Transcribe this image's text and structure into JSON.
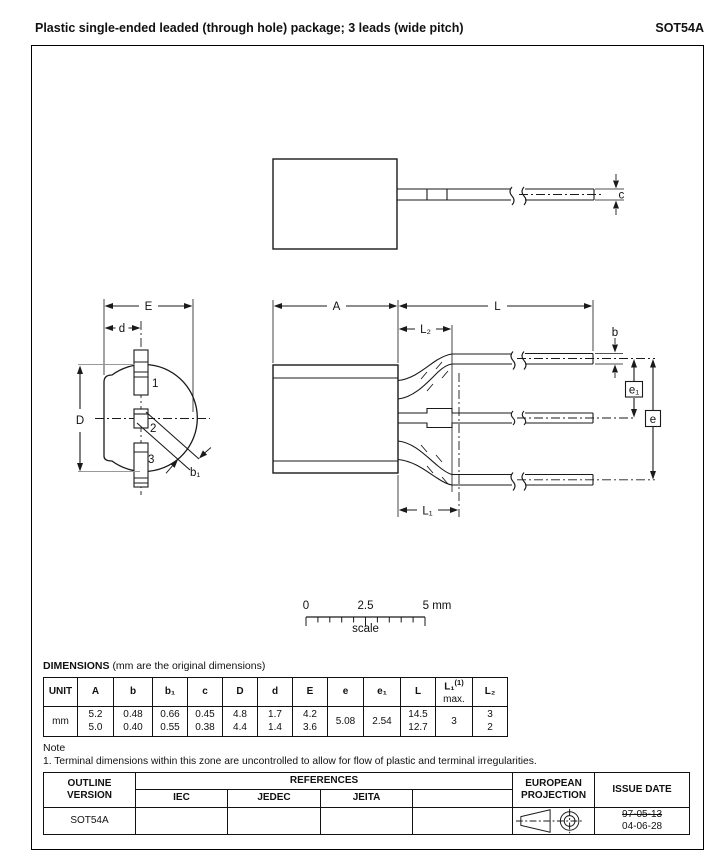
{
  "header": {
    "title": "Plastic single-ended leaded (through hole) package; 3 leads (wide pitch)",
    "package_code": "SOT54A"
  },
  "drawing": {
    "top_view": {
      "c": "c"
    },
    "front_view": {
      "E": "E",
      "d": "d",
      "D": "D",
      "b1": "b₁",
      "pin1": "1",
      "pin2": "2",
      "pin3": "3"
    },
    "side_view": {
      "A": "A",
      "L": "L",
      "L2": "L₂",
      "L1": "L₁",
      "b": "b",
      "e": "e",
      "e1": "e₁"
    },
    "scale_bar": {
      "t0": "0",
      "t1": "2.5",
      "t2": "5 mm",
      "caption": "scale"
    }
  },
  "dimensions": {
    "title": "DIMENSIONS",
    "subtitle": "(mm are the original dimensions)",
    "headers": {
      "unit": "UNIT",
      "a": "A",
      "b": "b",
      "b1": "b₁",
      "c": "c",
      "dcap": "D",
      "d": "d",
      "ecap": "E",
      "e": "e",
      "e1": "e₁",
      "l": "L",
      "l1": "L₁",
      "l1_sup": "(1)",
      "l1_max": "max.",
      "l2": "L₂"
    },
    "unit": "mm",
    "values": {
      "a": [
        "5.2",
        "5.0"
      ],
      "b": [
        "0.48",
        "0.40"
      ],
      "b1": [
        "0.66",
        "0.55"
      ],
      "c": [
        "0.45",
        "0.38"
      ],
      "dcap": [
        "4.8",
        "4.4"
      ],
      "d": [
        "1.7",
        "1.4"
      ],
      "ecap": [
        "4.2",
        "3.6"
      ],
      "e": [
        "5.08"
      ],
      "e1": [
        "2.54"
      ],
      "l": [
        "14.5",
        "12.7"
      ],
      "l1": [
        "3"
      ],
      "l2": [
        "3",
        "2"
      ]
    }
  },
  "note": {
    "heading": "Note",
    "item": "1. Terminal dimensions within this zone are uncontrolled to allow for flow of plastic and terminal irregularities."
  },
  "footer": {
    "outline_version": "OUTLINE VERSION",
    "references": "REFERENCES",
    "iec": "IEC",
    "jedec": "JEDEC",
    "jeita": "JEITA",
    "european_projection": "EUROPEAN PROJECTION",
    "issue_date": "ISSUE DATE",
    "outline_value": "SOT54A",
    "date_old": "97-05-13",
    "date_new": "04-06-28"
  }
}
